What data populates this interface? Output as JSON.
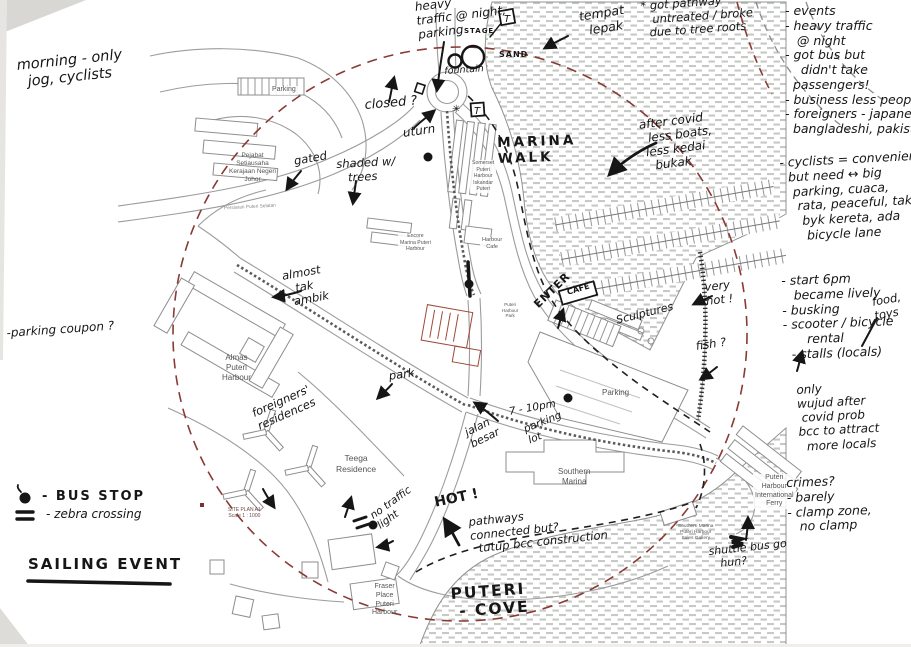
{
  "colors": {
    "ink": "#161616",
    "boundary_red": "#8a3a33",
    "map_line_gray": "#9c9c9c",
    "water_hatch": "#c6c9c5",
    "red_building_outline": "#a04838"
  },
  "map_labels": {
    "parking_nw": "Parking",
    "pejabat": [
      "Pejabat",
      "Setiausaha",
      "Kerajaan Negeri",
      "Johor"
    ],
    "somerset": [
      "Somerset",
      "Puteri",
      "Harbour",
      "Iskandar",
      "Puteri"
    ],
    "encore": [
      "Encore",
      "Marina Puteri",
      "Harbour"
    ],
    "harbour_cafe": [
      "Harbour",
      "Cafe"
    ],
    "almas": [
      "Almas",
      "Puteri",
      "Harbour"
    ],
    "teega": [
      "Teega",
      "Residence"
    ],
    "southern_marina": [
      "Southern",
      "Marina"
    ],
    "parking_east": "Parking",
    "fraser": [
      "Fraser",
      "Place",
      "Puteri",
      "Harbour"
    ],
    "ferry": [
      "Puteri",
      "Harbour",
      "International",
      "Ferry"
    ],
    "sales_gallery": [
      "Southern Marina",
      "Puteri Harbour",
      "Sales Gallery"
    ],
    "family_park": [
      "Puteri",
      "Harbour",
      "Park"
    ],
    "site_plan": [
      "SITE PLAN A1",
      "Scale 1 : 1000"
    ],
    "road_persiaran": "Persiaran Puteri Selatan"
  },
  "ink_notes": {
    "morning": [
      "morning - only",
      "  jog, cyclists"
    ],
    "parking_coupon": "-parking coupon ?",
    "heavy_traffic": [
      "heavy",
      "traffic @ night,",
      "parking"
    ],
    "stage": "STAGE",
    "sand": "SAND",
    "fountain": "fountain",
    "toilet": "T",
    "star": "✳",
    "tempat_lepak": [
      "tempat",
      "  lepak"
    ],
    "pathway_roots": [
      "* got pathway",
      "   untreated / broke",
      "  due to tree roots"
    ],
    "closed": "closed ?",
    "uturn": "uturn",
    "gated": "gated",
    "shaded_trees": [
      "shaded w/",
      "   trees"
    ],
    "marina_walk": [
      "MARINA",
      "WALK"
    ],
    "after_covid": [
      "after covid",
      "  less boats,",
      " less kedai",
      "   bukak"
    ],
    "almost_tak_ambik": [
      "almost",
      "   tak",
      "  ambik"
    ],
    "park": "park",
    "foreigners_residences": [
      "foreigners'",
      "residences"
    ],
    "jalan_besar": [
      "jalan",
      "besar"
    ],
    "seven_to_ten": "7 - 10pm",
    "parking_lot": [
      "parking",
      "lot"
    ],
    "enter": "ENTER",
    "cafe": "CAFE",
    "sculptures": "Sculptures",
    "very_hot": [
      "very",
      "hot !"
    ],
    "fish": "fish ?",
    "hot": "HOT !",
    "no_traffic_light": [
      "no traffic",
      "light"
    ],
    "pathways_connected": [
      "pathways",
      "connected but?",
      "  tutup bcc construction"
    ],
    "puteri_cove": [
      "PUTERI",
      " - COVE"
    ],
    "shuttle_bus": [
      "shuttle bus go",
      "   hun?"
    ]
  },
  "right_notes": {
    "events": [
      "- events",
      "- heavy traffic",
      "   @ night",
      "- got bus but",
      "    didn't take",
      "  passengers!",
      "- business less people",
      "- foreigners - japanese,",
      "  bangladeshi, pakistani"
    ],
    "cyclists": [
      "- cyclists = convenients",
      "  but need ↔ big",
      "   parking, cuaca,",
      "    rata, peaceful, tak",
      "     byk kereta, ada",
      "      bicycle lane"
    ],
    "evening": [
      "- start 6pm",
      "   became lively",
      "- busking",
      "- scooter / bicycle",
      "      rental",
      "  - stalls (locals)"
    ],
    "food_toys": [
      "food,",
      "toys"
    ],
    "covid": [
      "only",
      "wujud after",
      " covid prob",
      "bcc to attract",
      "  more locals"
    ],
    "crimes": [
      "crimes?",
      "- barely",
      "- clamp zone,",
      "   no clamp"
    ]
  },
  "legend": {
    "bus_stop": "- BUS STOP",
    "zebra": "- zebra crossing",
    "sailing_event": "SAILING EVENT",
    "bus_stop_symbol": "filled-dot",
    "zebra_symbol": "double-bar"
  }
}
